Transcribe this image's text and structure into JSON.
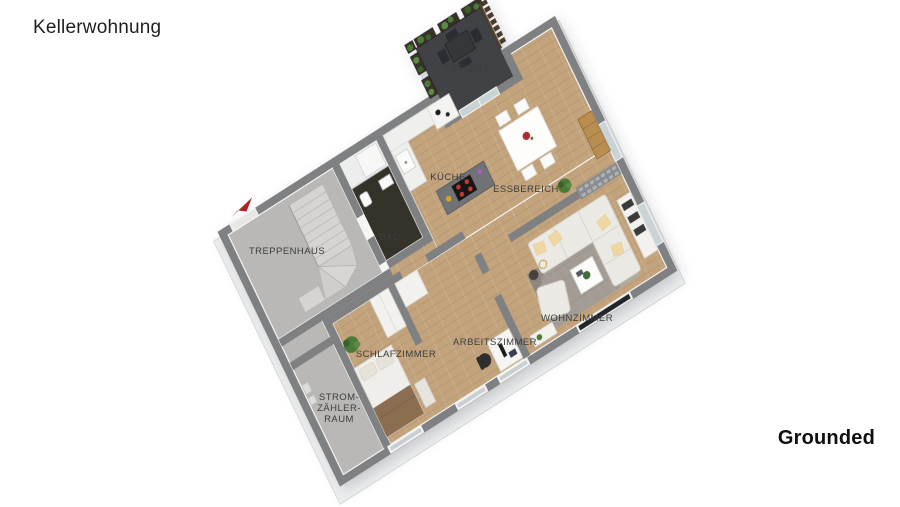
{
  "page": {
    "background": "#ffffff"
  },
  "header": {
    "title": "Kellerwohnung"
  },
  "branding": {
    "name": "Grounded"
  },
  "floorplan": {
    "view": "3d-isometric-floor-plan",
    "labels": {
      "freisitz": "FREISITZ",
      "kueche": "KÜCHE",
      "essbereich": "ESSBEREICH",
      "bad": "BAD",
      "treppenhaus": "TREPPENHAUS",
      "wohnzimmer": "WOHNZIMMER",
      "arbeitszimmer": "ARBEITSZIMMER",
      "schlafzimmer": "SCHLAFZIMMER",
      "strom_zaehler_raum_lines": [
        "STROM-",
        "ZÄHLER-",
        "RAUM"
      ]
    },
    "rooms": [
      {
        "label": "FREISITZ",
        "floor_color": "#3f4244"
      },
      {
        "label": "KÜCHE",
        "floor_color": "#c2a37c"
      },
      {
        "label": "ESSBEREICH",
        "floor_color": "#c2a37c"
      },
      {
        "label": "BAD",
        "floor_color": "#35312c"
      },
      {
        "label": "TREPPENHAUS",
        "floor_color": "#b9b8b6"
      },
      {
        "label": "WOHNZIMMER",
        "floor_color": "#c2a37c"
      },
      {
        "label": "ARBEITSZIMMER",
        "floor_color": "#c2a37c"
      },
      {
        "label": "SCHLAFZIMMER",
        "floor_color": "#c2a37c"
      },
      {
        "label": "STROM-ZÄHLER-RAUM",
        "floor_color": "#b9b8b6"
      }
    ],
    "colors": {
      "wall_top": "#7e8082",
      "wall_face": "#f5f5f3",
      "wood_floor": "#c2a37c",
      "concrete_floor": "#b9b8b6",
      "terrace_floor": "#3f4244",
      "bath_tile": "#35312c",
      "stairs": "#d5d4d1",
      "sofa": "#ebe9e3",
      "pillow": "#efd7a4",
      "rug": "#a29c94",
      "blanket": "#8a6e50",
      "island_top": "#707274",
      "cooktop": "#141414",
      "burner_red": "#c63b2e",
      "plant_green": "#4c7a38",
      "planter_brown": "#39302a",
      "fence_brown": "#4a3a2c",
      "north_arrow_red": "#b32025",
      "label_text": "#3d3d3d",
      "title_text": "#1f1f1f"
    }
  }
}
